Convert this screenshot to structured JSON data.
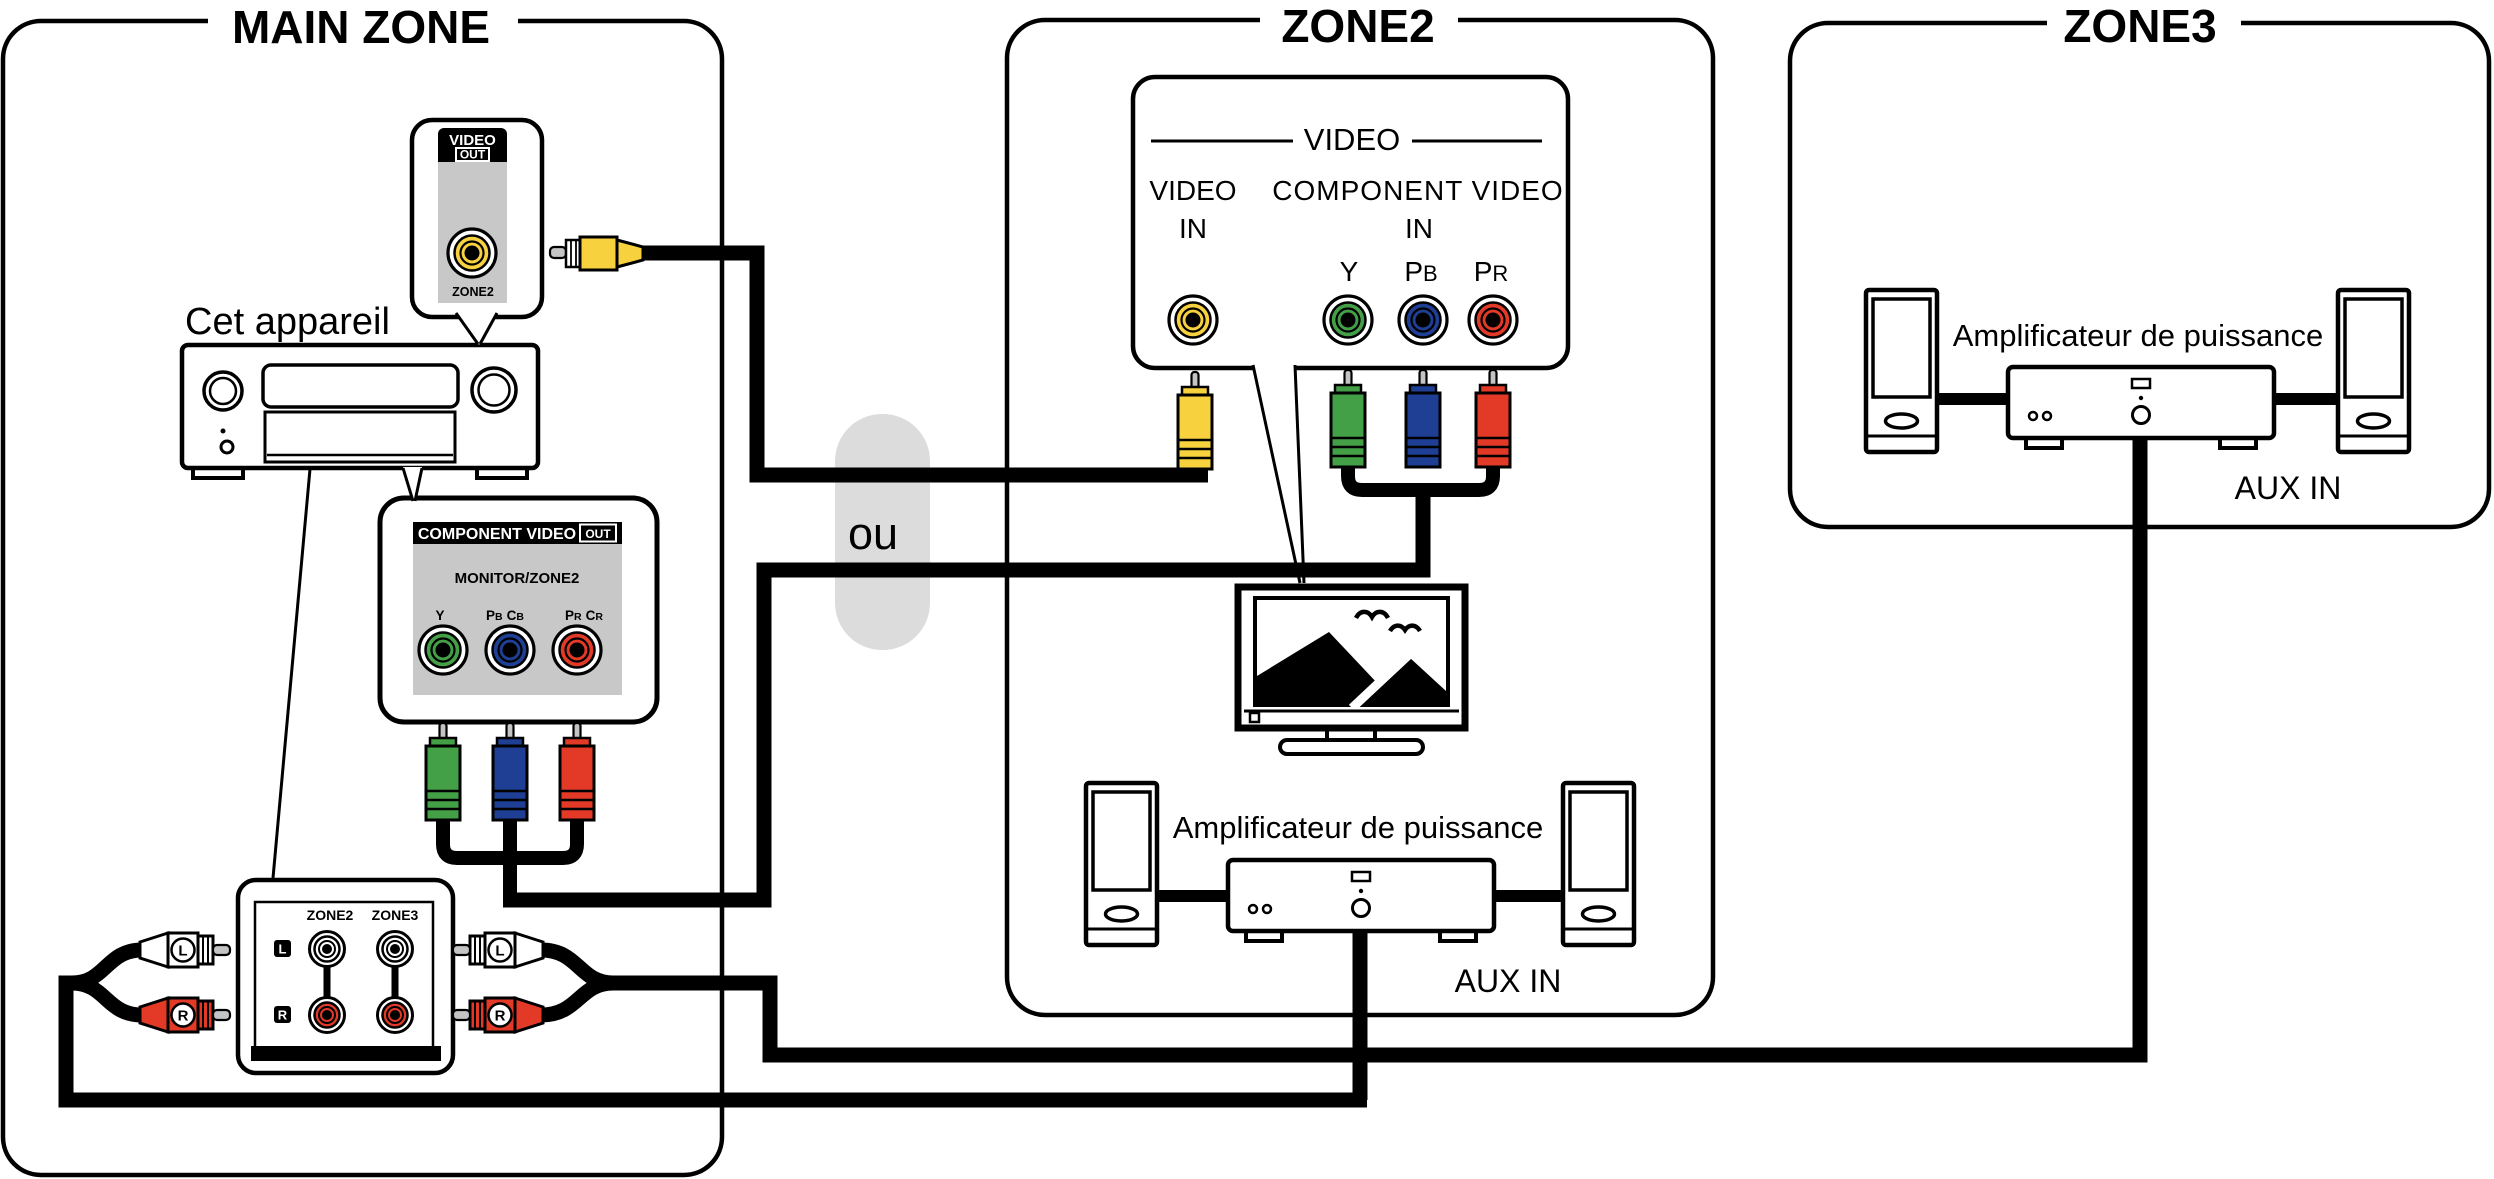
{
  "zones": {
    "main": {
      "title": "MAIN ZONE",
      "device_label": "Cet appareil",
      "video_out_panel": {
        "header": "VIDEO",
        "badge": "OUT",
        "jack_label": "ZONE2"
      },
      "component_panel": {
        "header": "COMPONENT VIDEO",
        "badge": "OUT",
        "subtitle": "MONITOR/ZONE2",
        "jack_labels": [
          {
            "text": "Y"
          },
          {
            "parts": [
              "P",
              "B",
              "C",
              "B"
            ]
          },
          {
            "parts": [
              "P",
              "R",
              "C",
              "R"
            ]
          }
        ]
      },
      "audio_panel": {
        "columns": [
          "ZONE2",
          "ZONE3"
        ],
        "rows": [
          "L",
          "R"
        ],
        "left_plugs": [
          "L",
          "R"
        ],
        "right_plugs": [
          "L",
          "R"
        ]
      }
    },
    "zone2": {
      "title": "ZONE2",
      "video_panel": {
        "header": "VIDEO",
        "video_in": {
          "label": "VIDEO",
          "sub_label": "IN"
        },
        "component_in": {
          "label": "COMPONENT VIDEO",
          "sub_label": "IN"
        },
        "jack_labels": [
          {
            "text": "Y"
          },
          {
            "main": "P",
            "sub": "B"
          },
          {
            "main": "P",
            "sub": "R"
          }
        ]
      },
      "amplifier_label": "Amplificateur de puissance",
      "aux_in_label": "AUX IN"
    },
    "zone3": {
      "title": "ZONE3",
      "amplifier_label": "Amplificateur de puissance",
      "aux_in_label": "AUX IN"
    }
  },
  "connector_label": "ou",
  "colors": {
    "yellow": "#F7D23E",
    "green": "#44A047",
    "blue": "#1E3F94",
    "red": "#E33A28",
    "panel_gray": "#C8C8C8",
    "capsule_gray": "#DCDCDC",
    "pin_gray": "#C4C4C4"
  }
}
